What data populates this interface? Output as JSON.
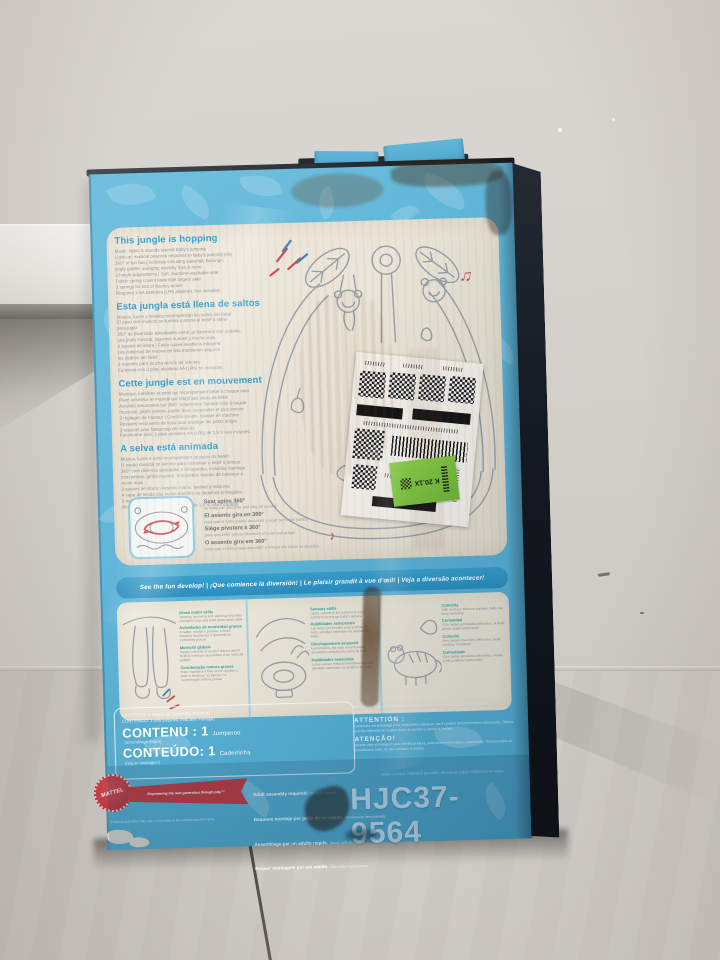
{
  "colors": {
    "box_blue": "#5bb2d6",
    "heading_blue": "#2f9cce",
    "dev_heading_teal": "#2fa2a0",
    "accent_red": "#cf4a4c",
    "accent_blue_dash": "#3f7fba",
    "mattel_red": "#c03a40",
    "sticker_green": "#7cc43f",
    "box_side_dark": "#141922",
    "panel_cream": "#e8e3d6",
    "wall_gray": "#d5d1cc",
    "floor_gray": "#cbc7c2"
  },
  "icons": {
    "music_note_double": "♫",
    "music_note_single": "♪"
  },
  "box": {
    "features": {
      "en": {
        "heading": "This jungle is hopping",
        "body": "Music, lights & sounds reward baby's jumping\nLight-up, musical peacock responds to baby's jumping play\n360° of fun busy activities including waterfall, flamingo,\njingle giraffe, swinging monkey toys & more\n3 height adjustments | Soft, machine-washable seat\nFabric spring covers keep little fingers safe\n3 springs for lots of bouncy action\nRequires 3 AA batteries (LR6 alkaline). Not included."
      },
      "es": {
        "heading": "Esta jungla está llena de saltos",
        "body": "Música, luces y sonidos recompensan los saltos del bebé\nEl pavo real musical se ilumina y anima al bebé a saltar\npara jugar\n360° de divertidas actividades como un flamenco con pedales,\nuna jirafa musical, juguetes suaves y mucho más\n3 ajustes de altura | Falda suave lavable a máquina\nLas cubiertas de resorte de tela mantienen seguros\nlos deditos del bebé\n3 resortes para mucha acción de rebotes\nFunciona con 3 pilas alcalinas AA (LR6) no incluidas."
      },
      "fr": {
        "heading": "Cette jungle est en mouvement",
        "body": "Musique, lumières et sons qui récompensent bébé à chaque saut\nPaon lumineux et musical qui réagit aux sauts de bébé\nActivités amusantes sur 360°, notamment flamant rose à boucle\nmusicale, girafe sonore, jouets doux suspendus et plus encore\n3 réglages de hauteur | Coussin souple, lavable en machine\nRessorts recouverts de tissu pour protéger les petits doigts\n3 ressorts pour beaucoup de rebonds\nFonctionne avec 3 piles alcalines AA (LR6) de 1,5 V non incluses."
      },
      "pt": {
        "heading": "A selva está animada",
        "body": "Música, luzes e sons recompensam os pulos do bebê!\nO pavão musical se ilumina para incentivar o bebê a brincar\n360° com diversas atividades e brinquedos, incluindo flamingo\ncom pedais, girafa musical, brinquedos macios de balançar e\nmuito mais\n3 ajustes de altura | Assento macio, lavável à máquina\nA capa de tecido das molas mantém os dedinhos protegidos\n3 molas para se divertir pulando\nRequer 3 pilhas alcalinas AA (LR6) de 1,5 V, não incluídas."
      }
    },
    "callouts_360": [
      {
        "bold": "Seat spins 360°",
        "small": "so baby can discover and play all around"
      },
      {
        "bold": "El asiento gira en 360°",
        "small": "para que el bebé pueda descubrir y jugar por todas partes"
      },
      {
        "bold": "Siège pivotant à 360°",
        "small": "pour que bébé puisse découvrir et jouer tout autour"
      },
      {
        "bold": "O assento gira em 360°",
        "small": "para que o bebê possa descobrir e brincar em todas as direções"
      }
    ],
    "banner": {
      "text": "See the fun develop!  |  ¡Que comience la diversión!  |  Le plaisir grandit à vue d'œil!  |  Veja a diversão acontecer!"
    },
    "development": [
      {
        "en_head": "Gross motor skills",
        "en_body": "Jumping, bouncing and standing help baby strengthen legs and build gross motor skills",
        "es_head": "Actividades de motricidad gruesa",
        "es_body": "Al saltar, rebotar y pararse, el bebé fortalece las piernas y desarrolla la motricidad gruesa",
        "fr_head": "Motricité globale",
        "fr_body": "Sauter, rebondir et se tenir debout aident bébé à renforcer ses jambes et sa motricité globale",
        "pt_head": "Coordenação motora grossa",
        "pt_body": "Pular, equilibrar e ficar em pé ajudam o bebê a fortalecer as pernas e a coordenação motora grossa"
      },
      {
        "en_head": "Sensory skills",
        "en_body": "Lights, sounds & fun textures in every activity help engage baby's senses",
        "es_head": "Habilidades sensoriales",
        "es_body": "Las luces, los sonidos y las texturas de cada actividad estimulan los sentidos del bebé",
        "fr_head": "Développement sensoriel",
        "fr_body": "Les lumières, les sons et les textures amusantes stimulent les sens de bébé",
        "pt_head": "Habilidades sensoriais",
        "pt_body": "Luzes, sons e texturas divertidas em cada atividade estimulam os sentidos do bebê"
      },
      {
        "en_head": "Curiosity",
        "en_body": "With so many different activities, baby can keep exploring!",
        "es_head": "Curiosidad",
        "es_body": "¡Con tantas actividades diferentes, el bebé puede seguir explorando!",
        "fr_head": "Curiosité",
        "fr_body": "Avec autant d'activités différentes, bébé continue d'explorer!",
        "pt_head": "Curiosidade",
        "pt_body": "Com tantas atividades diferentes, o bebê pode continuar explorando!"
      }
    ],
    "contents": {
      "small_en": "CONTENTS: 1 Jumperoo (assembly required)",
      "small_es": "CONTENIDO: 1 silla saltarina (requiere montaje)",
      "fr_big": "CONTENU : 1",
      "fr_name": "Jumperoo",
      "fr_note": "(assemblage requis)",
      "pt_big": "CONTEÚDO: 1",
      "pt_name": "Cadeirinha",
      "pt_note": "(requer montagem)"
    },
    "assembly": [
      {
        "bold": "Adult assembly required.",
        "small": "No tools needed."
      },
      {
        "bold": "Requiere montaje por parte de un adulto.",
        "small": "No necesita herramientas."
      },
      {
        "bold": "Assemblage par un adulte requis.",
        "small": "Aucun outil nécessaire."
      },
      {
        "bold": "Requer montagem por um adulto.",
        "small": "Não requer ferramentas."
      }
    ],
    "attention": {
      "tiny_en": "IMPORTANT! Keep this packaging for future reference as it contains important information.",
      "tiny_es": "¡IMPORTANTE! Conserve el empaque para futura referencia, ya que contiene información importante.",
      "fr_head": "ATTENTION :",
      "fr_body": "Conservez cet emballage pour consultation ultérieure, car il contient des informations importantes. Retirez tous les éléments de fixation avant de donner le produit à l'enfant.",
      "pt_head": "ATENÇÃO!",
      "pt_body": "Guarde esta embalagem para referência futura, pois contém informações importantes. Remova todos os prendedores antes de dar o produto à criança."
    },
    "made_in": "MADE IN CHINA / FABRIQUÉ EN CHINE / HECHO EN CHINA / FABRICADO NA CHINA",
    "product_number": "HJC37-9564",
    "mattel": {
      "brand": "MATTEL",
      "tagline": "Empowering the next generation through play™",
      "note": "Products and colors may vary. Les produits et les couleurs peuvent varier."
    },
    "sticker": {
      "text": "K 20.1X"
    }
  }
}
